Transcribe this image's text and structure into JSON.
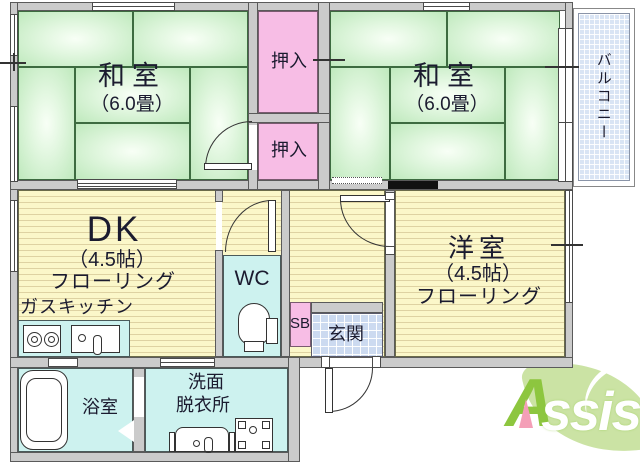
{
  "plan": {
    "washitsu_left": {
      "name": "和室",
      "size": "（6.0畳）"
    },
    "washitsu_right": {
      "name": "和室",
      "size": "（6.0畳）"
    },
    "oshiire_upper": {
      "label": "押入"
    },
    "oshiire_lower": {
      "label": "押入"
    },
    "balcony": {
      "label": "バルコニー"
    },
    "dk": {
      "name": "DK",
      "size": "（4.5帖）",
      "flooring": "フローリング",
      "kitchen": "ガスキッチン"
    },
    "wc": {
      "label": "WC"
    },
    "shoe_box": {
      "label": "SB"
    },
    "genkan": {
      "label": "玄関"
    },
    "youshitsu": {
      "name": "洋室",
      "size": "（4.5帖）",
      "flooring": "フローリング"
    },
    "bathroom": {
      "label": "浴室"
    },
    "washroom": {
      "line1": "洗面",
      "line2": "脱衣所"
    }
  },
  "logo": {
    "a": "A",
    "rest": "ssist"
  },
  "colors": {
    "tatami_green": "#cdeccb",
    "closet_pink": "#f7bde5",
    "water_cyan": "#cdf2ef",
    "floor_yellow": "#fbf7c9",
    "entry_blue": "#ccdaf0",
    "balcony_blue": "#d9e4f4",
    "wall_gray": "#cbcbcb",
    "logo_leaf_green": "#cbe3a4",
    "logo_letter_green": "#8dc63f",
    "logo_pink": "#f49fb7"
  }
}
